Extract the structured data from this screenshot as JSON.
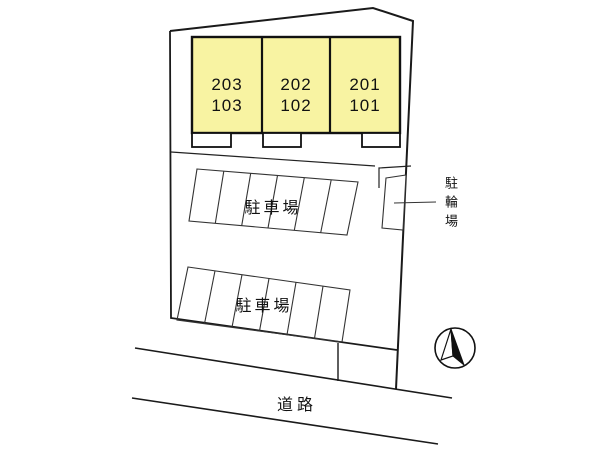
{
  "site_plan": {
    "building": {
      "units": [
        {
          "upper": "203",
          "lower": "103"
        },
        {
          "upper": "202",
          "lower": "102"
        },
        {
          "upper": "201",
          "lower": "101"
        }
      ]
    },
    "labels": {
      "parking_lot_upper": "駐車場",
      "parking_lot_lower": "駐車場",
      "bicycle_parking": "駐輪場",
      "road": "道路"
    },
    "parking": {
      "upper_lot_stall_count": 6,
      "lower_lot_stall_count": 6
    },
    "icons": {
      "north_arrow": "north-arrow-compass"
    },
    "colors": {
      "unit_fill": "#f8f3a2",
      "line": "#1a1a1a",
      "background": "#ffffff"
    }
  }
}
